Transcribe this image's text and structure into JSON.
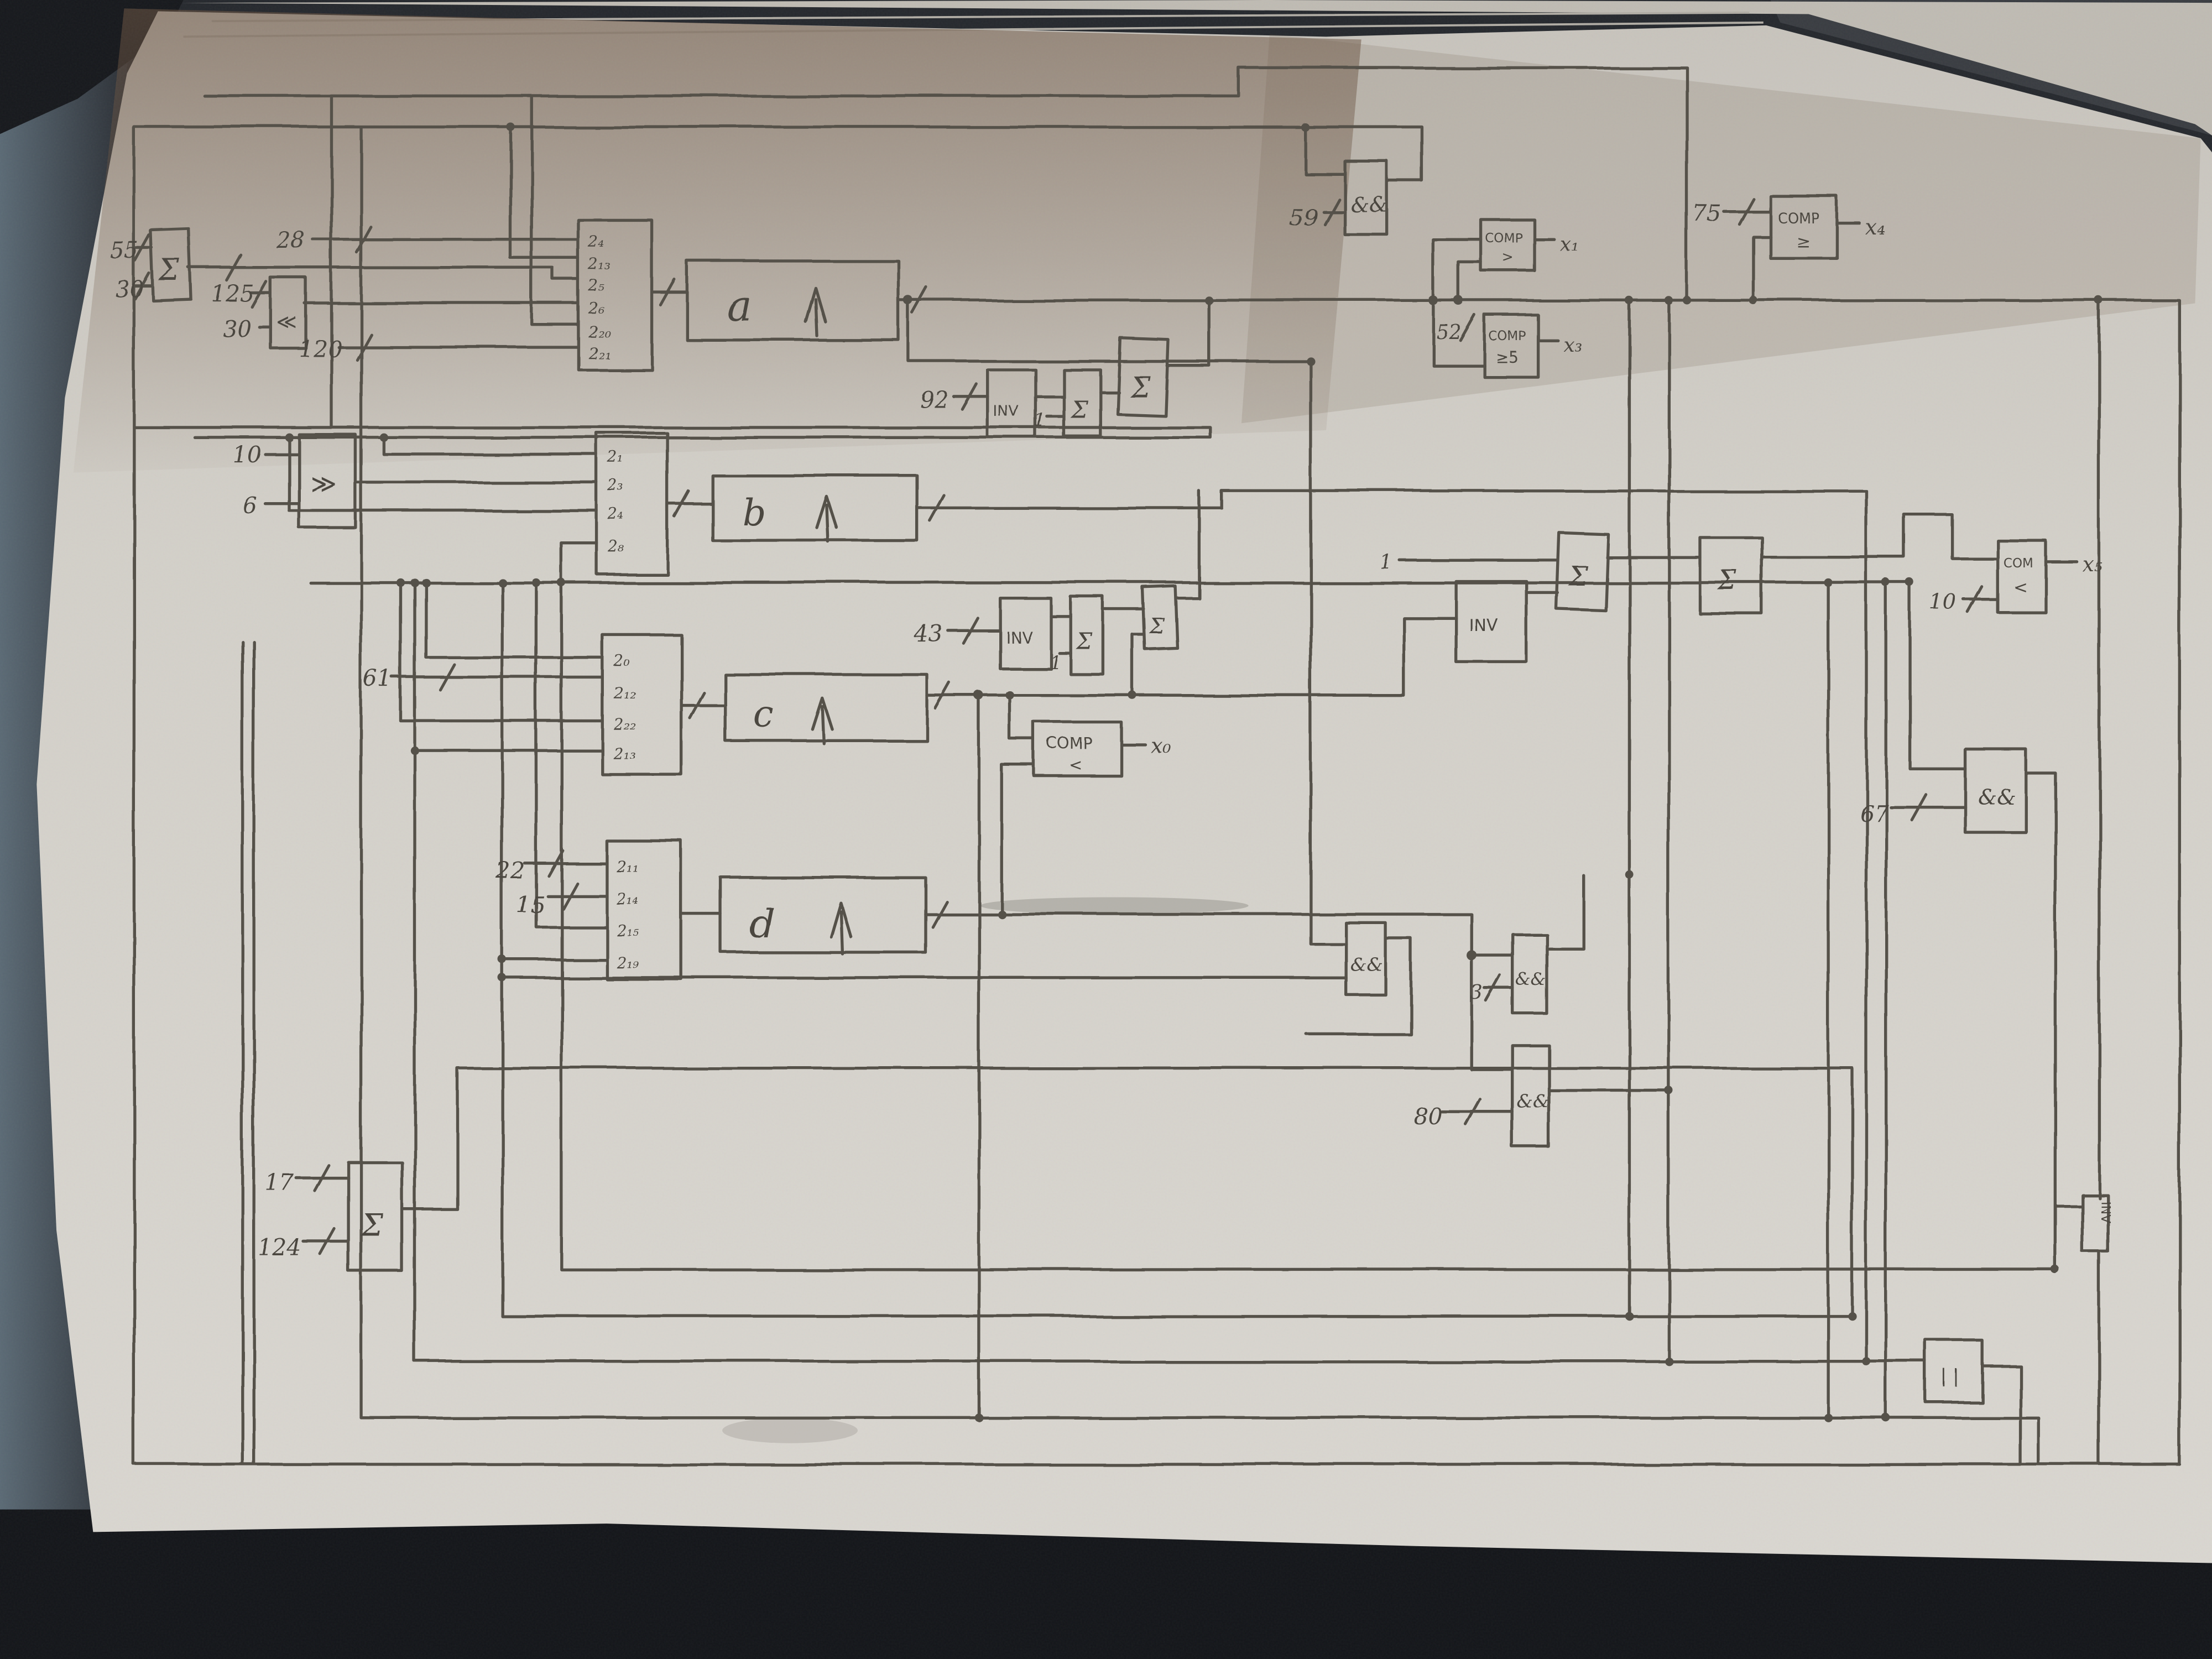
{
  "colors": {
    "paper": "#d3d0c9",
    "pencil": "#55514a",
    "desk": "#26292e",
    "desk_side": "#55646e",
    "desk_bottom": "#14161a",
    "shadow_brown": "#6b5442"
  },
  "t": {
    "n55": "55",
    "n30a": "30",
    "n28": "28",
    "n125": "125",
    "n30b": "30",
    "n120": "120",
    "n10": "10",
    "n6": "6",
    "n61": "61",
    "n92": "92",
    "n43": "43",
    "one_a": "1",
    "one_b": "1",
    "one_c": "1",
    "n59": "59",
    "n52": "52",
    "n75": "75",
    "n10b": "10",
    "n67": "67",
    "n22": "22",
    "n15": "15",
    "n3": "3",
    "n80": "80",
    "n17": "17",
    "n124": "124",
    "sum": "Σ",
    "inv": "INV",
    "and": "&&",
    "shl": "≪",
    "shr": "≫",
    "orbar": "| |",
    "comp": "COMP",
    "com": "COM",
    "gt": ">",
    "ge": "≥",
    "ge5": "≥5",
    "lt": "<",
    "a": "a",
    "b": "b",
    "c": "c",
    "d": "d",
    "x0": "x₀",
    "x1": "x₁",
    "x3": "x₃",
    "x4": "x₄",
    "x5": "x₅",
    "ra0": "2₄",
    "ra1": "2₁₃",
    "ra2": "2₅",
    "ra3": "2₆",
    "ra4": "2₂₀",
    "ra5": "2₂₁",
    "rb0": "2₁",
    "rb1": "2₃",
    "rb2": "2₄",
    "rb3": "2₈",
    "rc0": "2₀",
    "rc1": "2₁₂",
    "rc2": "2₂₂",
    "rc3": "2₁₃",
    "rd0": "2₁₁",
    "rd1": "2₁₄",
    "rd2": "2₁₅",
    "rd3": "2₁₉"
  }
}
